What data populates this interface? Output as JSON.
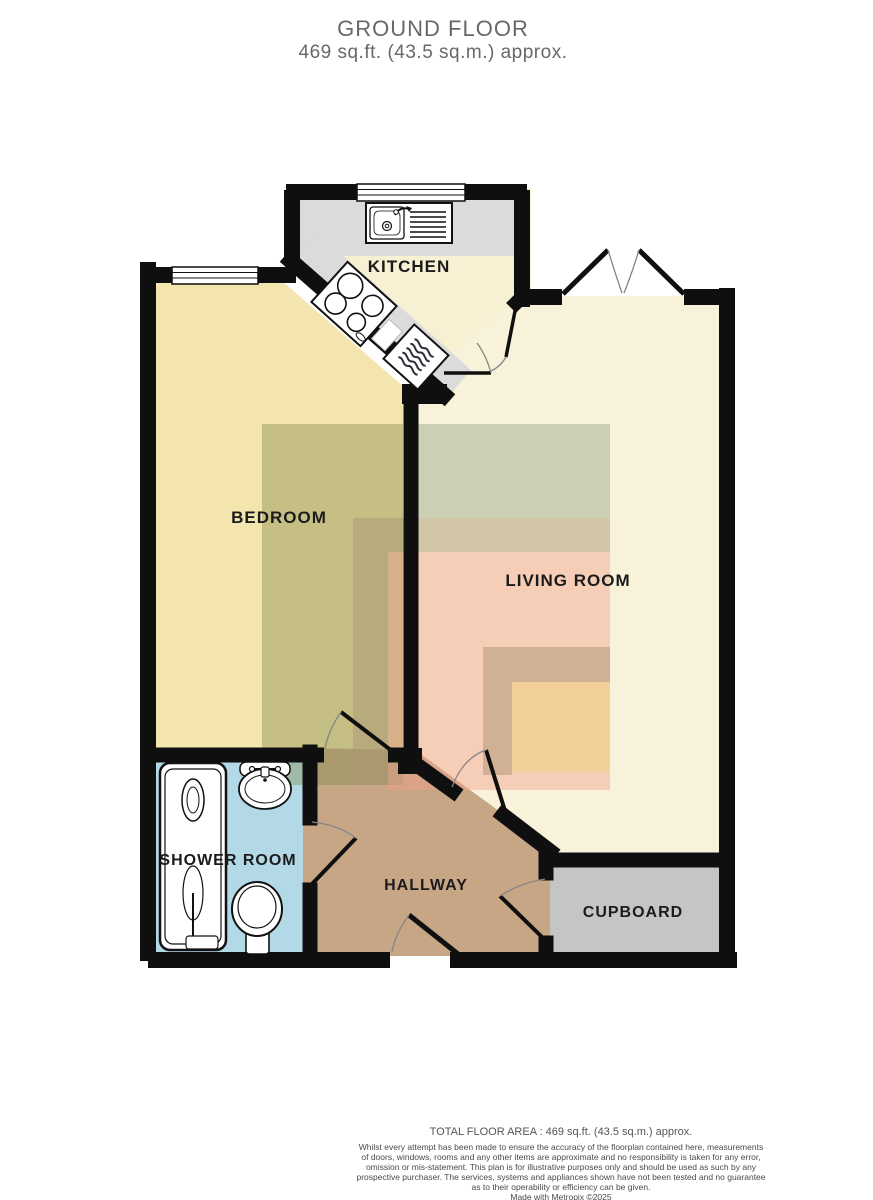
{
  "header": {
    "title": "GROUND FLOOR",
    "subtitle": "469 sq.ft. (43.5 sq.m.) approx."
  },
  "rooms": {
    "kitchen": "KITCHEN",
    "bedroom": "BEDROOM",
    "living": "LIVING ROOM",
    "shower": "SHOWER ROOM",
    "hallway": "HALLWAY",
    "cupboard": "CUPBOARD"
  },
  "footer": {
    "total": "TOTAL FLOOR AREA : 469 sq.ft. (43.5 sq.m.) approx.",
    "disclaimer_lines": [
      "Whilst every attempt has been made to ensure the accuracy of the floorplan contained here, measurements",
      "of doors, windows, rooms and any other items are approximate and no responsibility is taken for any error,",
      "omission or mis-statement. This plan is for illustrative purposes only and should be used as such by any",
      "prospective purchaser. The services, systems and appliances shown have not been tested and no guarantee",
      "as to their operability or efficiency can be given."
    ],
    "credit": "Made with Metropix ©2025"
  },
  "colors": {
    "wall": "#0f0f0f",
    "bedroom": "#f4e4ad",
    "kitchen_floor": "#f8f0d3",
    "living": "#f9f2db",
    "shower": "#b4d9e6",
    "hallway": "#c7a686",
    "cupboard": "#c6c5c5",
    "counter": "#dbdbdb",
    "overlay_olive": "rgba(130,140,80,0.42)",
    "overlay_green": "rgba(150,165,135,0.45)",
    "overlay_tan": "rgba(170,150,115,0.5)",
    "overlay_pink": "rgba(242,160,140,0.45)",
    "overlay_yellow": "rgba(238,212,125,0.55)"
  }
}
